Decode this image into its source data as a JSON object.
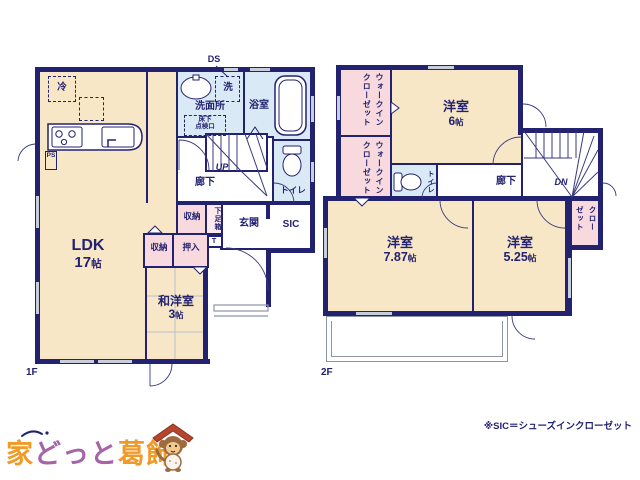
{
  "floor1": {
    "label": "1F",
    "ds": "DS",
    "ldk": {
      "name": "LDK",
      "size_num": "17",
      "size_unit": "帖"
    },
    "washitsu": {
      "name": "和洋室",
      "size_num": "3",
      "size_unit": "帖"
    },
    "senmenjo": "洗面所",
    "laundry": "洗",
    "fridge": "冷",
    "yukashita_line1": "床下",
    "yukashita_line2": "点検口",
    "bath": "浴室",
    "toilet": "トイレ",
    "hall": "廊下",
    "up": "UP",
    "ps": "PS",
    "shuno_a": "収納",
    "shuno_b": "収納",
    "oshiire": "押入",
    "getabako": "下足箱",
    "getabako_t": "T",
    "genkan": "玄関",
    "sic": "SIC"
  },
  "floor2": {
    "label": "2F",
    "room6": {
      "name": "洋室",
      "size_num": "6",
      "size_unit": "帖"
    },
    "room787": {
      "name": "洋室",
      "size_num": "7.87",
      "size_unit": "帖"
    },
    "room525": {
      "name": "洋室",
      "size_num": "5.25",
      "size_unit": "帖"
    },
    "wic_a": "ウォークインクローゼット",
    "wic_b": "ウォークインクローゼット",
    "closet": "クローゼット",
    "toilet": "トイレ",
    "hall": "廊下",
    "dn": "DN"
  },
  "footnote": "※SIC＝シューズインクローゼット",
  "logo": {
    "part1": "家",
    "part2": "どっと",
    "part3": "葛飾"
  },
  "colors": {
    "wall": "#232270",
    "room_cream": "#f8e7c6",
    "closet_pink": "#f8d9de",
    "wet_blue": "#d9eaf6",
    "logo_orange": "#f09a28",
    "logo_purple": "#a763a7",
    "mascot_roof": "#b5452f"
  }
}
